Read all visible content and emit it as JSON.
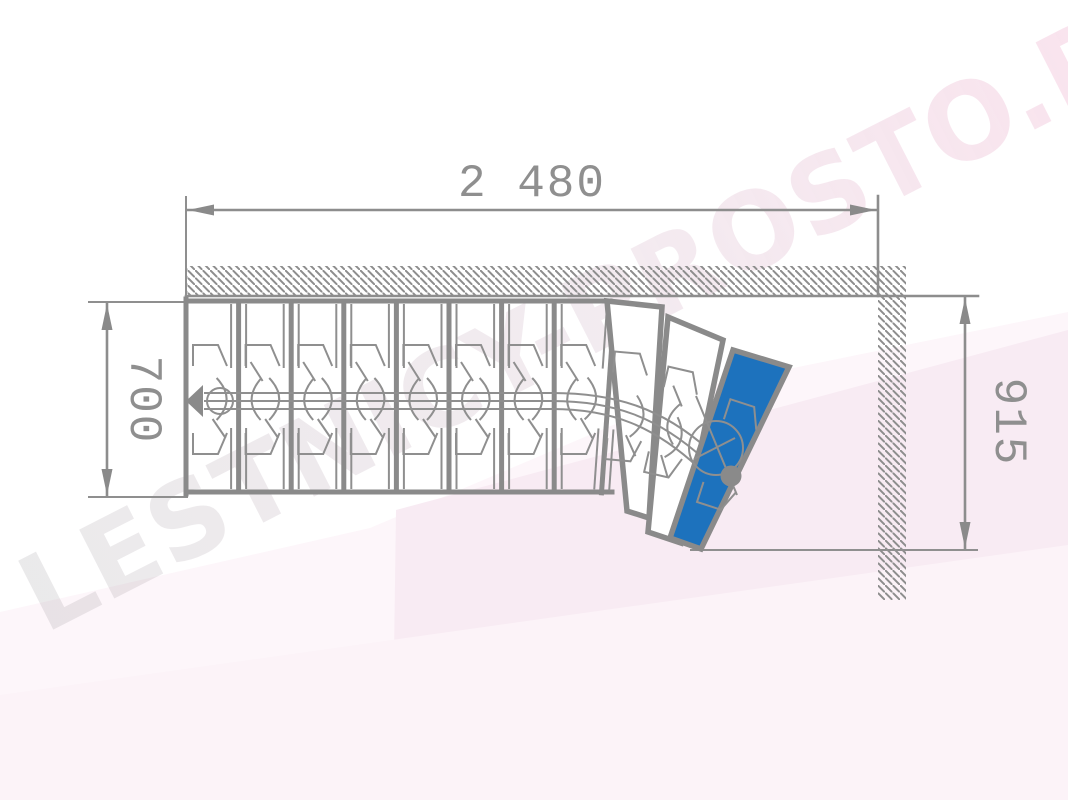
{
  "watermark": {
    "text": "LESTNICY-PROSTO.RU"
  },
  "dimensions": {
    "total_length": {
      "value": "2 480"
    },
    "flight_width": {
      "value": "700"
    },
    "turn_width": {
      "value": "915"
    }
  },
  "plan": {
    "straight_steps": 8,
    "winder_steps": 3,
    "total_steps": 11,
    "highlighted_step": 11,
    "colors": {
      "line": "#8a8a8a",
      "highlighted_step_fill": "#1d72bd",
      "background_tint": "#f8ebf3"
    }
  }
}
